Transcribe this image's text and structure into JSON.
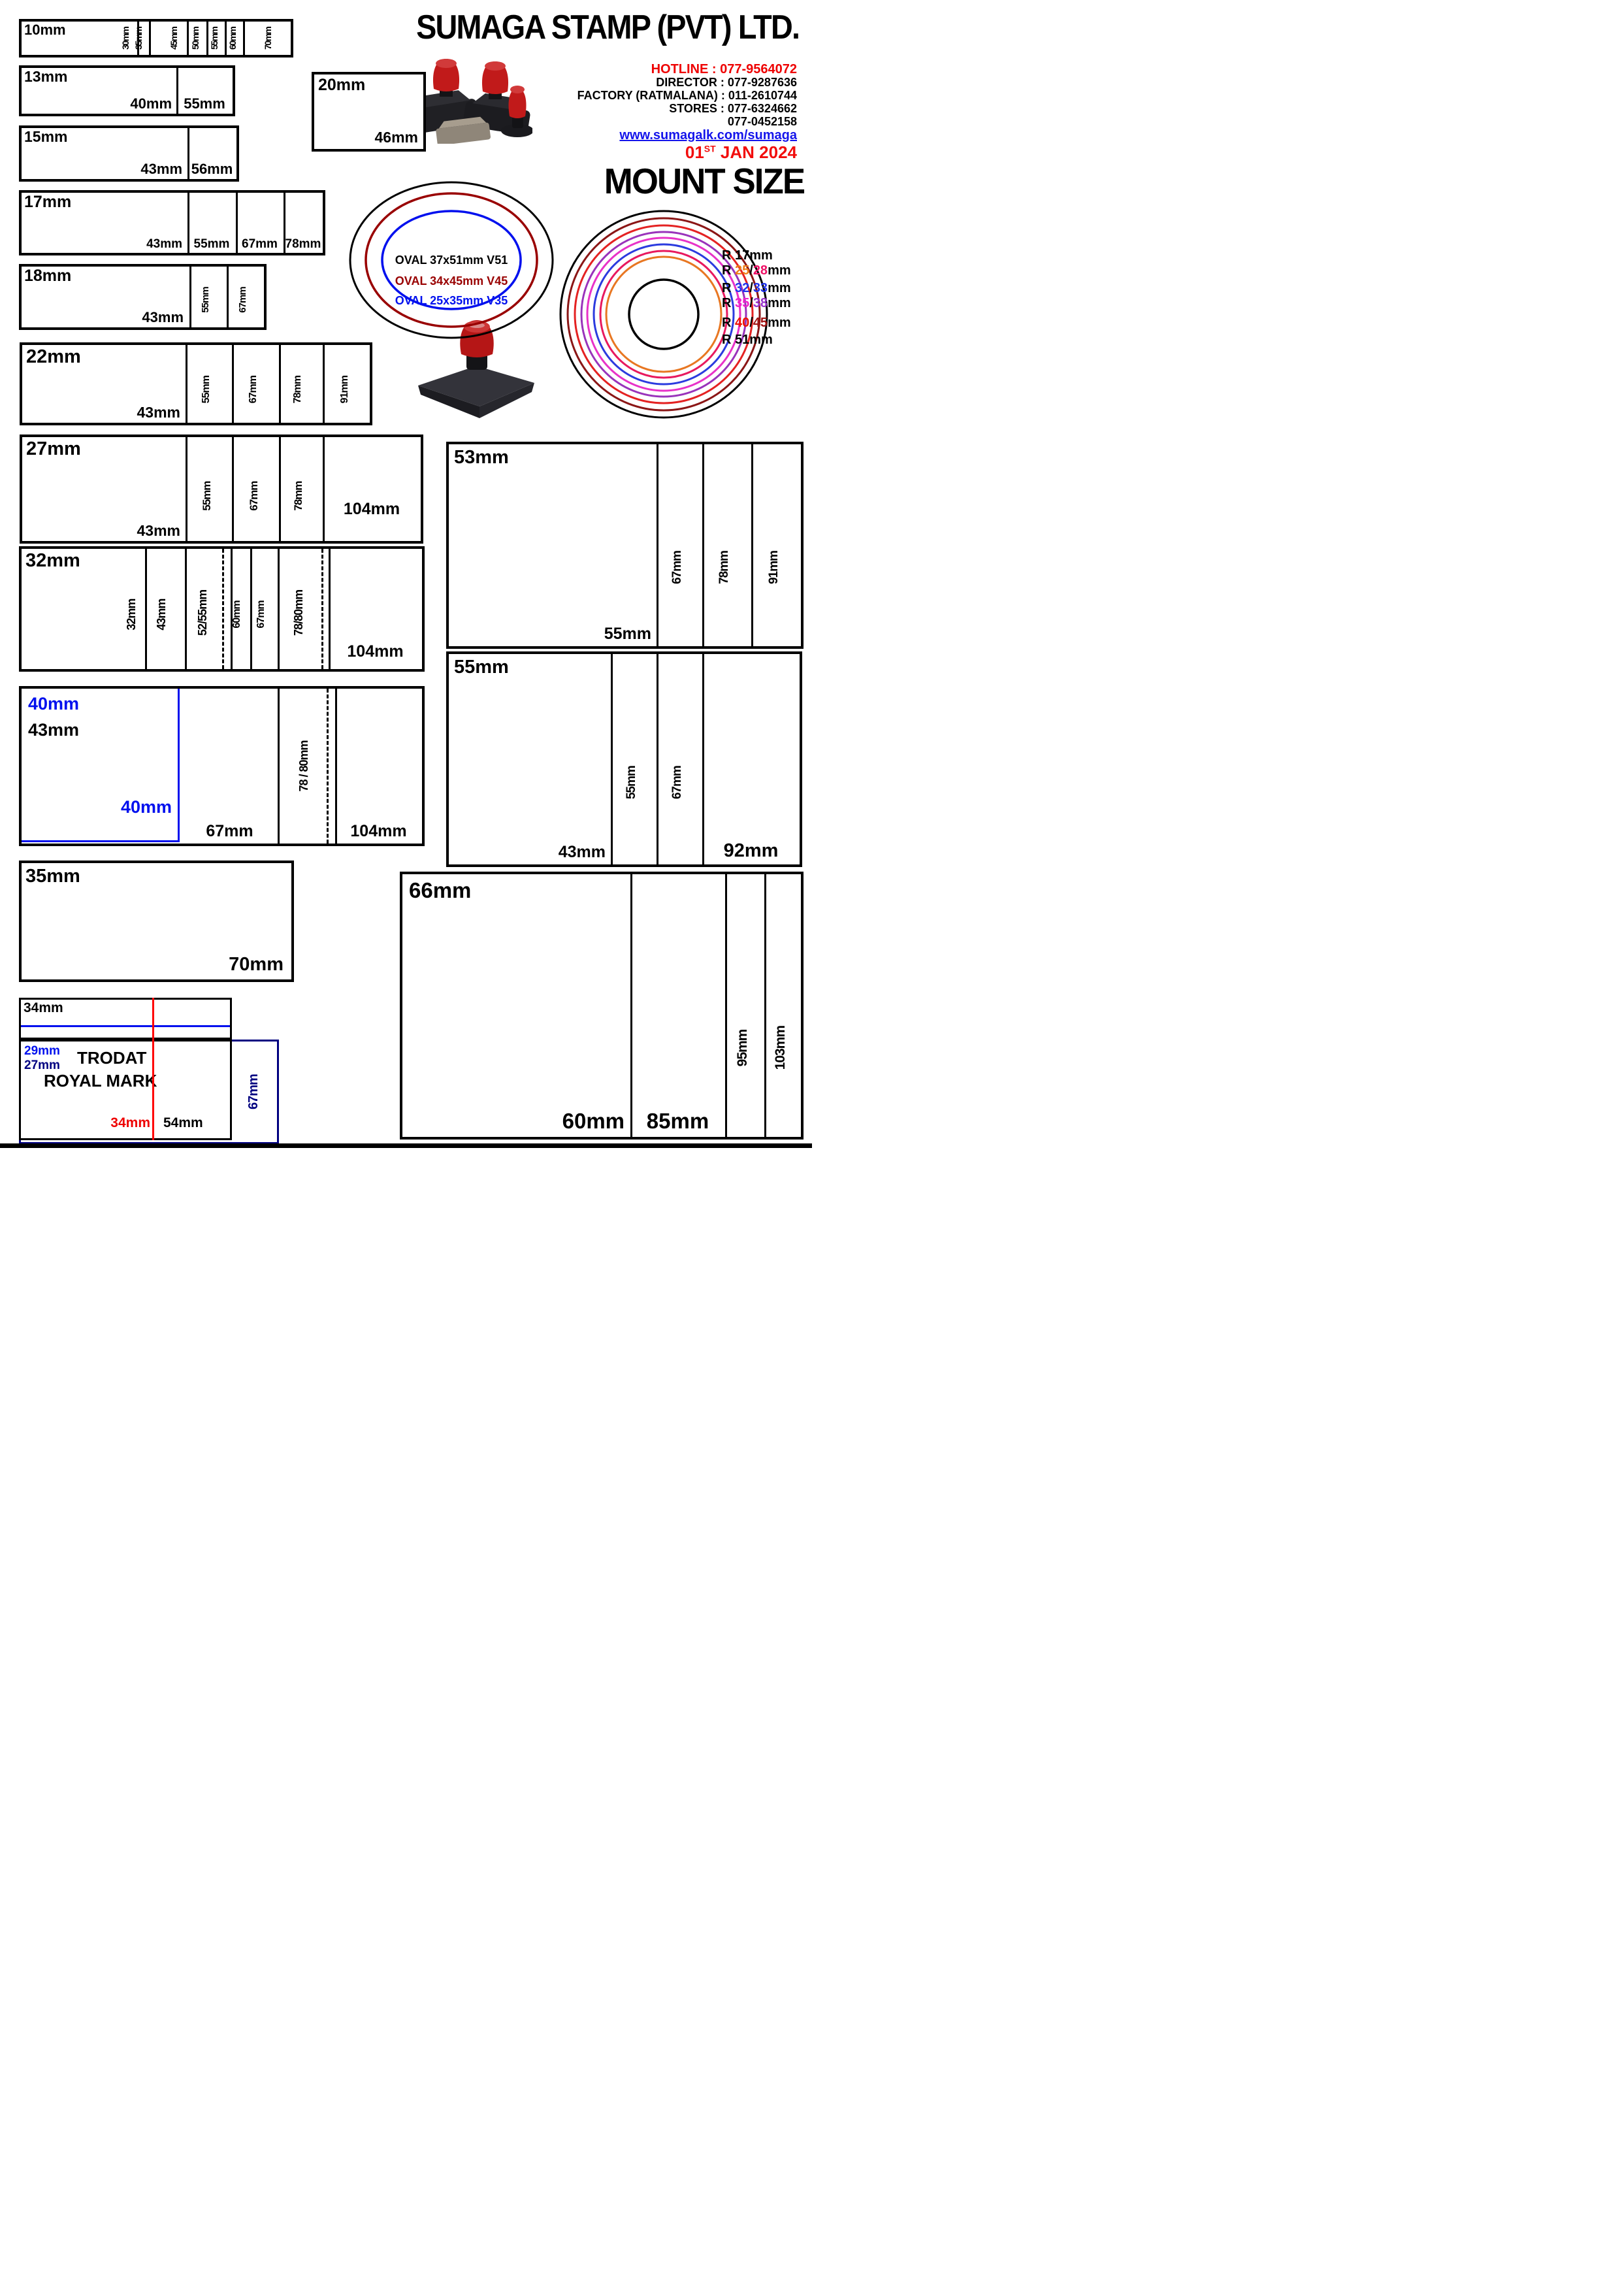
{
  "header": {
    "company": "SUMAGA STAMP (PVT) LTD.",
    "contacts": [
      {
        "text": "HOTLINE : 077-9564072",
        "color": "#ee0000"
      },
      {
        "text": "DIRECTOR : 077-9287636",
        "color": "#000000"
      },
      {
        "text": "FACTORY (RATMALANA) : 011-2610744",
        "color": "#000000"
      },
      {
        "text": "STORES : 077-6324662",
        "color": "#000000"
      },
      {
        "text": "077-0452158",
        "color": "#000000"
      }
    ],
    "website": "www.sumagalk.com/sumaga",
    "date": {
      "day": "01",
      "sup": "ST",
      "rest": " JAN 2024"
    },
    "mount_size": "MOUNT SIZE"
  },
  "ovals": {
    "labels": [
      {
        "text": "OVAL 37x51mm V51",
        "color": "#000000"
      },
      {
        "text": "OVAL 34x45mm V45",
        "color": "#990000"
      },
      {
        "text": "OVAL 25x35mm V35",
        "color": "#0010ee"
      }
    ],
    "ring_colors": [
      "#000000",
      "#990000",
      "#0010ee"
    ]
  },
  "circles": {
    "ring_colors": [
      "#000000",
      "#8b1616",
      "#e42222",
      "#9933bb",
      "#e832c8",
      "#2b3bdf",
      "#e8195e",
      "#e87722",
      "#000000"
    ],
    "labels": [
      {
        "pre": "R ",
        "a": "17",
        "ca": "#000000",
        "slash": "",
        "b": "",
        "cb": "#000000",
        "post": "mm"
      },
      {
        "pre": "R ",
        "a": "25",
        "ca": "#ef7f1a",
        "slash": "/",
        "b": "28",
        "cb": "#ee1166",
        "post": "mm"
      },
      {
        "pre": "R ",
        "a": "32",
        "ca": "#2233ee",
        "slash": "/",
        "b": "33",
        "cb": "#2233ee",
        "post": "mm"
      },
      {
        "pre": "R ",
        "a": "35",
        "ca": "#ee22cc",
        "slash": "/",
        "b": "38",
        "cb": "#9933cc",
        "post": "mm"
      },
      {
        "pre": "R ",
        "a": "40",
        "ca": "#ee1100",
        "slash": "/",
        "b": "45",
        "cb": "#a01313",
        "post": "mm"
      },
      {
        "pre": "R ",
        "a": "51",
        "ca": "#000000",
        "slash": "",
        "b": "",
        "cb": "#000000",
        "post": "mm"
      }
    ]
  },
  "rows": {
    "r10": {
      "label": "10mm",
      "v": [
        "30mm",
        "35mm",
        "45mm",
        "50mm",
        "55mm",
        "60mm",
        "70mm"
      ]
    },
    "r13": {
      "label": "13mm",
      "c1": "40mm",
      "c2": "55mm"
    },
    "r20": {
      "label": "20mm",
      "c1": "46mm"
    },
    "r15": {
      "label": "15mm",
      "c1": "43mm",
      "c2": "56mm"
    },
    "r17": {
      "label": "17mm",
      "cols": [
        "43mm",
        "55mm",
        "67mm",
        "78mm"
      ]
    },
    "r18": {
      "label": "18mm",
      "c1": "43mm",
      "v": [
        "55mm",
        "67mm"
      ]
    },
    "r22": {
      "label": "22mm",
      "c1": "43mm",
      "v": [
        "55mm",
        "67mm",
        "78mm",
        "91mm"
      ]
    },
    "r27": {
      "label": "27mm",
      "c1": "43mm",
      "v": [
        "55mm",
        "67mm",
        "78mm"
      ],
      "wide": "104mm"
    },
    "r32": {
      "label": "32mm",
      "v": [
        "32mm",
        "43mm",
        "52/55mm",
        "60mm",
        "67mm",
        "78/80mm"
      ],
      "wide": "104mm"
    },
    "r40": {
      "blue_top": "40mm",
      "label": "43mm",
      "blue_bottom": "40mm",
      "c1": "67mm",
      "v": "78 / 80mm",
      "wide": "104mm"
    },
    "r35": {
      "label": "35mm",
      "c1": "70mm"
    },
    "r34": {
      "label": "34mm"
    },
    "trodat": {
      "blue": "29mm",
      "navy": "27mm",
      "line1": "TRODAT",
      "line2": "ROYAL MARK",
      "red": "34mm",
      "c1": "54mm",
      "side": "67mm"
    },
    "r53": {
      "label": "53mm",
      "c1": "55mm",
      "v": [
        "67mm",
        "78mm",
        "91mm"
      ]
    },
    "r55": {
      "label": "55mm",
      "c1": "43mm",
      "v": [
        "55mm",
        "67mm"
      ],
      "wide": "92mm"
    },
    "r66": {
      "label": "66mm",
      "c1": "60mm",
      "c2": "85mm",
      "v": [
        "95mm",
        "103mm"
      ]
    }
  }
}
